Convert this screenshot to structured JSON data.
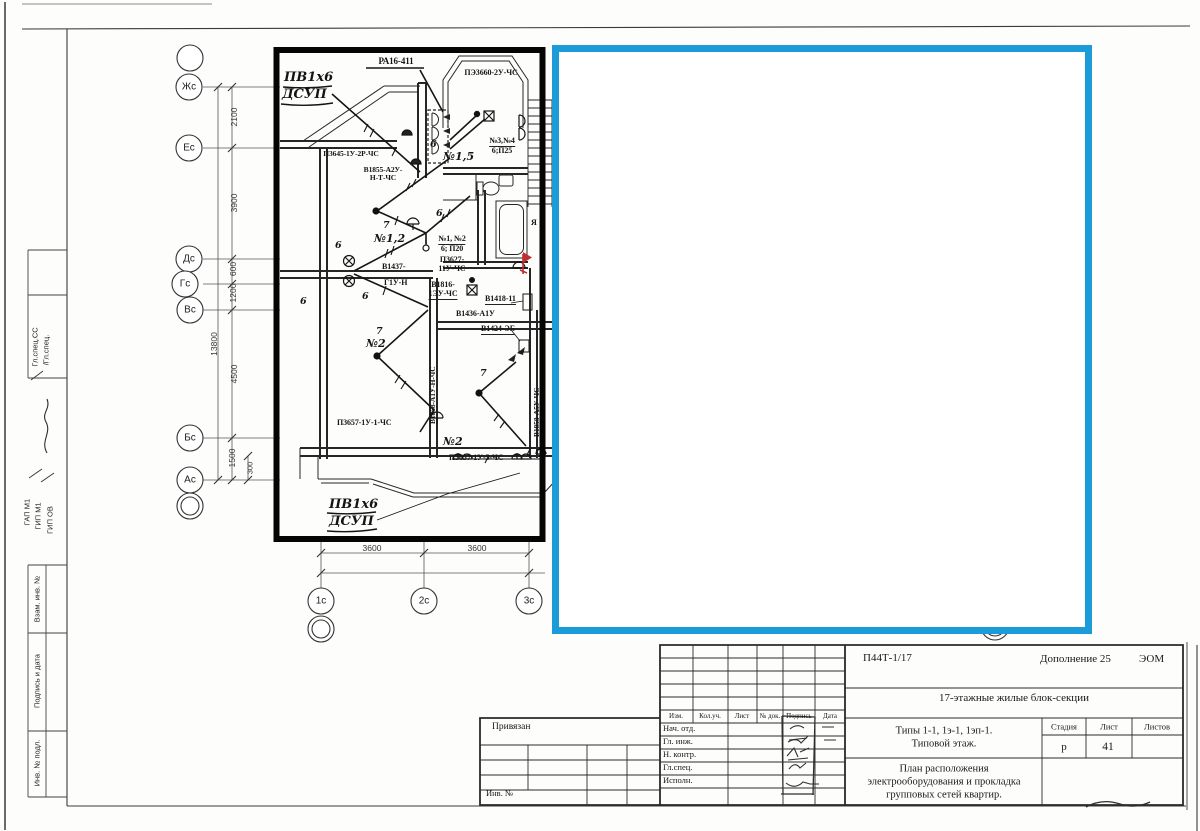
{
  "annotations": {
    "black_box_color": "#000000",
    "cyan_box_color": "#1b9cd8"
  },
  "sidebar": {
    "spec1": "Гл.спец.СС",
    "spec2": "/Гл.спец.",
    "gap": "ГАП М1",
    "gip1": "ГИП М1",
    "gip2": "ГИП ОВ",
    "vzam": "Взам. инв. №",
    "podp": "Подпись и дата",
    "inv": "Инв. № подл."
  },
  "plan": {
    "axes": {
      "left": [
        "Жс",
        "Ес",
        "Дс",
        "Гс",
        "Вс",
        "Бс",
        "Ас"
      ],
      "bottom": [
        "1с",
        "2с",
        "3с"
      ]
    },
    "dims": {
      "left": [
        "2100",
        "3900",
        "600",
        "1200",
        "4500",
        "1500"
      ],
      "overall": "13800",
      "small": "300",
      "bottom1": "3600",
      "bottom2": "3600"
    },
    "labels": {
      "pa16": "РА16-411",
      "pe3660": "ПЭ3660-2У-ЧС",
      "p3645": "П3645-1У-2Р-ЧС",
      "v1855_1": "В1855-А2У-",
      "v1855_2": "Н-Т-ЧС",
      "n34_1": "№3,№4",
      "n34_2": "6;П25",
      "n12_1": "№1, №2",
      "n12_2": "6; П20",
      "p3627_1": "П3627-",
      "p3627_2": "11У-ЧС",
      "v1437_1": "В1437-",
      "v1437_2": "Г1У-Н",
      "v1816_1": "В1816-",
      "v1816_2": "1ЭУ-ЧС",
      "v1418": "В1418-11",
      "v1436": "В1436-А1У",
      "v1424": "В1424-ЭБ",
      "v1858_left": "В1858-А1У-Н-ЧС",
      "v1858_right": "В1858-А5У-ЧС",
      "p3657_left": "П3657-1У-1-ЧС",
      "p3657_right": "П3657-1У-5-ЧС",
      "w6": "6",
      "w7": "7",
      "ya": "Я"
    },
    "handwritten": {
      "pv": "ПВ1х6",
      "dsup": "ДСУП",
      "n15": "№1,5",
      "n12": "№1,2",
      "n2": "№2"
    }
  },
  "title_block": {
    "code": "П44Т-1/17",
    "supplement": "Дополнение 25",
    "dept": "ЭОМ",
    "object_name": "17-этажные жилые блок-секции",
    "type_line1": "Типы 1-1, 1э-1, 1эп-1.",
    "type_line2": "Типовой этаж.",
    "sheet_line1": "План расположения",
    "sheet_line2": "электрооборудования  и прокладка",
    "sheet_line3": "групповых сетей квартир.",
    "stage_label": "Стадия",
    "stage": "р",
    "sheet_label": "Лист",
    "sheet_no": "41",
    "sheets_label": "Листов",
    "cols": [
      "Изм.",
      "Кол.уч.",
      "Лист",
      "№ док.",
      "Подпись",
      "Дата"
    ],
    "rows": [
      "Нач. отд.",
      "Гл. инж.",
      "Н. контр.",
      "Гл.спец.",
      "Исполн."
    ],
    "left_top": "Привязан",
    "left_bottom": "Инв. №"
  }
}
